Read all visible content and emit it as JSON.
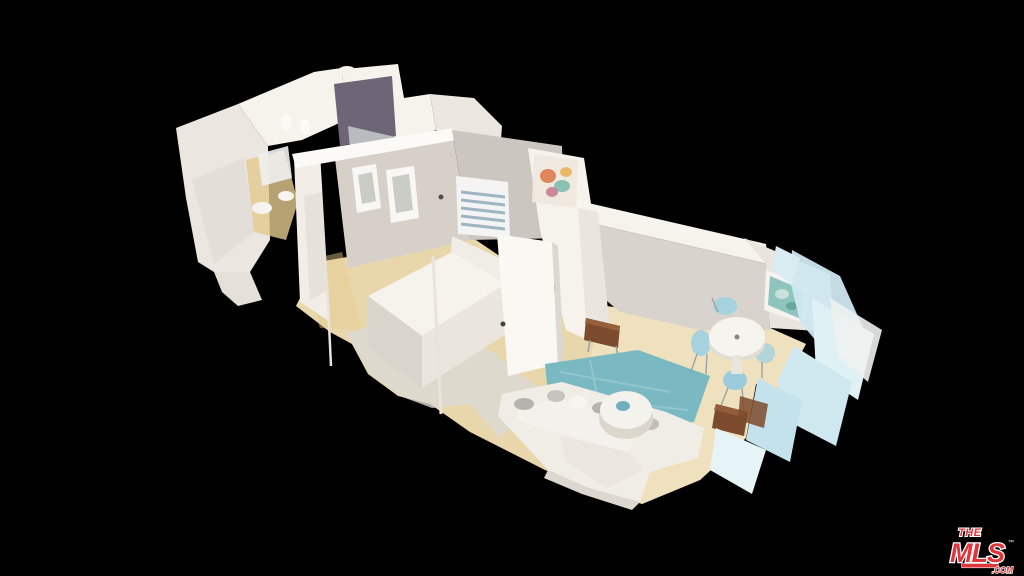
{
  "scene": {
    "type": "3d-dollhouse-tour",
    "description": "Overhead 3D dollhouse scan of a one-bedroom apartment floating on a black background",
    "rooms": [
      "bathroom",
      "kitchen",
      "hallway",
      "bedroom",
      "living-room",
      "dining-area"
    ]
  },
  "colors": {
    "background": "#000000",
    "wall_bright": "#f6f3ed",
    "wall_white": "#ebe7e0",
    "wall_shade": "#d8d3cb",
    "wall_gray": "#cbc6bf",
    "wall_beige": "#d6d0c8",
    "niche_dark": "#6e6676",
    "floor_wood": "#e9d7ac",
    "floor_wood_light": "#f1e5c5",
    "rug_gray": "#dbdad6",
    "rug_teal": "#7ab8c2",
    "sofa_white": "#f0ede6",
    "chair_blue": "#a6d2de",
    "leather_brown": "#7c4a2d",
    "glitch_blue": "#cfe7ef",
    "steel": "#b9bcbe",
    "gold": "#e4c98f",
    "logo_red": "#e0363b"
  },
  "watermark": {
    "the": "THE",
    "mls": "MLS",
    "tm": "™",
    "com": ".COM"
  }
}
